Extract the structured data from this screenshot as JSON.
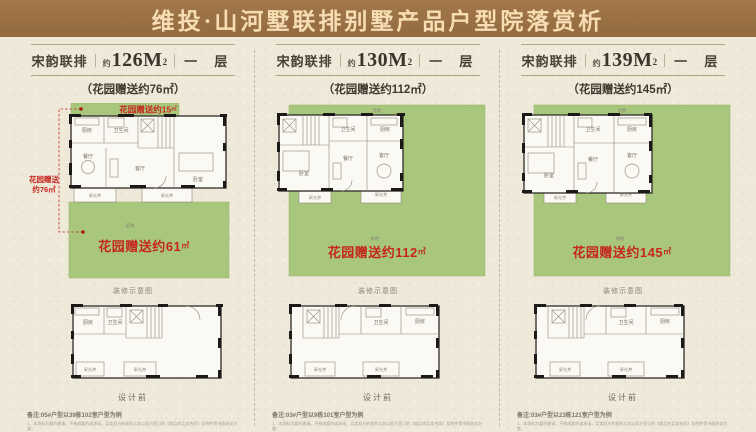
{
  "title": "维投·山河墅联排别墅产品户型院落赏析",
  "colors": {
    "header_bg": "#9a6f44",
    "header_text": "#f6ddb4",
    "paper": "#efe9da",
    "garden_green": "#a9c77c",
    "accent_red": "#c5261f",
    "wall_black": "#1c1a18",
    "rule_brown": "#b3a284"
  },
  "shared": {
    "approx": "约",
    "sup2": "2",
    "unit": "㎡",
    "decor_caption": "装修示意图",
    "design_caption": "设计前",
    "rooms": {
      "kitchen": "厨房",
      "bath": "卫生间",
      "dining": "餐厅",
      "living": "客厅",
      "bedroom": "卧室",
      "lightwell": "采光井",
      "yard_north": "北院",
      "yard_south": "南院",
      "courtyard": "庭院"
    },
    "disclaimer": {
      "line1": "1、本资料为要约邀请，不构成要约或承诺，买卖双方的权利义务以双方签订的《商品房买卖合同》及附件等书面协议为准；",
      "line2": "2、花园为赠送面积，不计入产权面积，图示面积均为约数，最终以政府相关部门核准文件及实际交付为准；",
      "line3": "3、本户型图仅作示意参考，装修、家具、绿化等仅为效果示意，开发商保留对宣传资料的最终解释权。"
    }
  },
  "panels": [
    {
      "series": "宋韵联排",
      "area": "126M",
      "floor": "一 层",
      "subtitle": "（花园赠送约76㎡）",
      "garden_top": "花园赠送约15",
      "garden_left_line1": "花园赠送",
      "garden_left_line2": "约76㎡",
      "garden_main": "花园赠送约61",
      "note": "备注:05#户型以39栋102室户型为例"
    },
    {
      "series": "宋韵联排",
      "area": "130M",
      "floor": "一 层",
      "subtitle": "（花园赠送约112㎡）",
      "garden_main": "花园赠送约112",
      "note": "备注:03#户型以9栋101室户型为例"
    },
    {
      "series": "宋韵联排",
      "area": "139M",
      "floor": "一 层",
      "subtitle": "（花园赠送约145㎡）",
      "garden_main": "花园赠送约145",
      "note": "备注:03#户型以23栋121室户型为例"
    }
  ]
}
